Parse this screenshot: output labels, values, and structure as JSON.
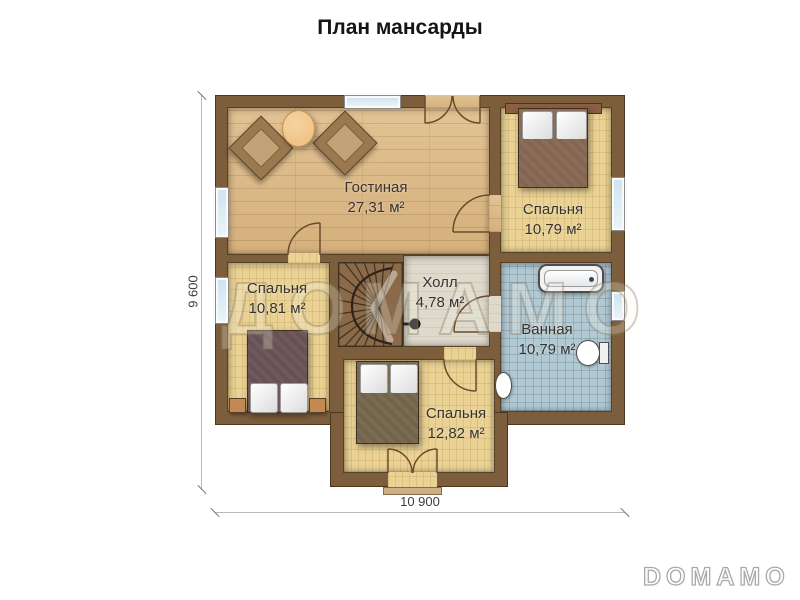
{
  "title": "План мансарды",
  "watermark_text": "ДОМАМО",
  "brand_logo": "DOMAMO",
  "dimensions": {
    "horizontal": "10 900",
    "vertical": "9 600"
  },
  "rooms": {
    "living": {
      "name": "Гостиная",
      "area": "27,31 м²"
    },
    "bedroom_tr": {
      "name": "Спальня",
      "area": "10,79 м²"
    },
    "bedroom_left": {
      "name": "Спальня",
      "area": "10,81 м²"
    },
    "hall": {
      "name": "Холл",
      "area": "4,78 м²"
    },
    "bathroom": {
      "name": "Ванная",
      "area": "10,79 м²"
    },
    "bedroom_bottom": {
      "name": "Спальня",
      "area": "12,82 м²"
    }
  },
  "colors": {
    "wall": "#7d5e3c",
    "wood_floor": "#dcba89",
    "parquet_floor": "#e9d294",
    "hall_floor": "#ded9cb",
    "bath_floor": "#b2c9d4",
    "window_glass": "#cfe4ef"
  }
}
